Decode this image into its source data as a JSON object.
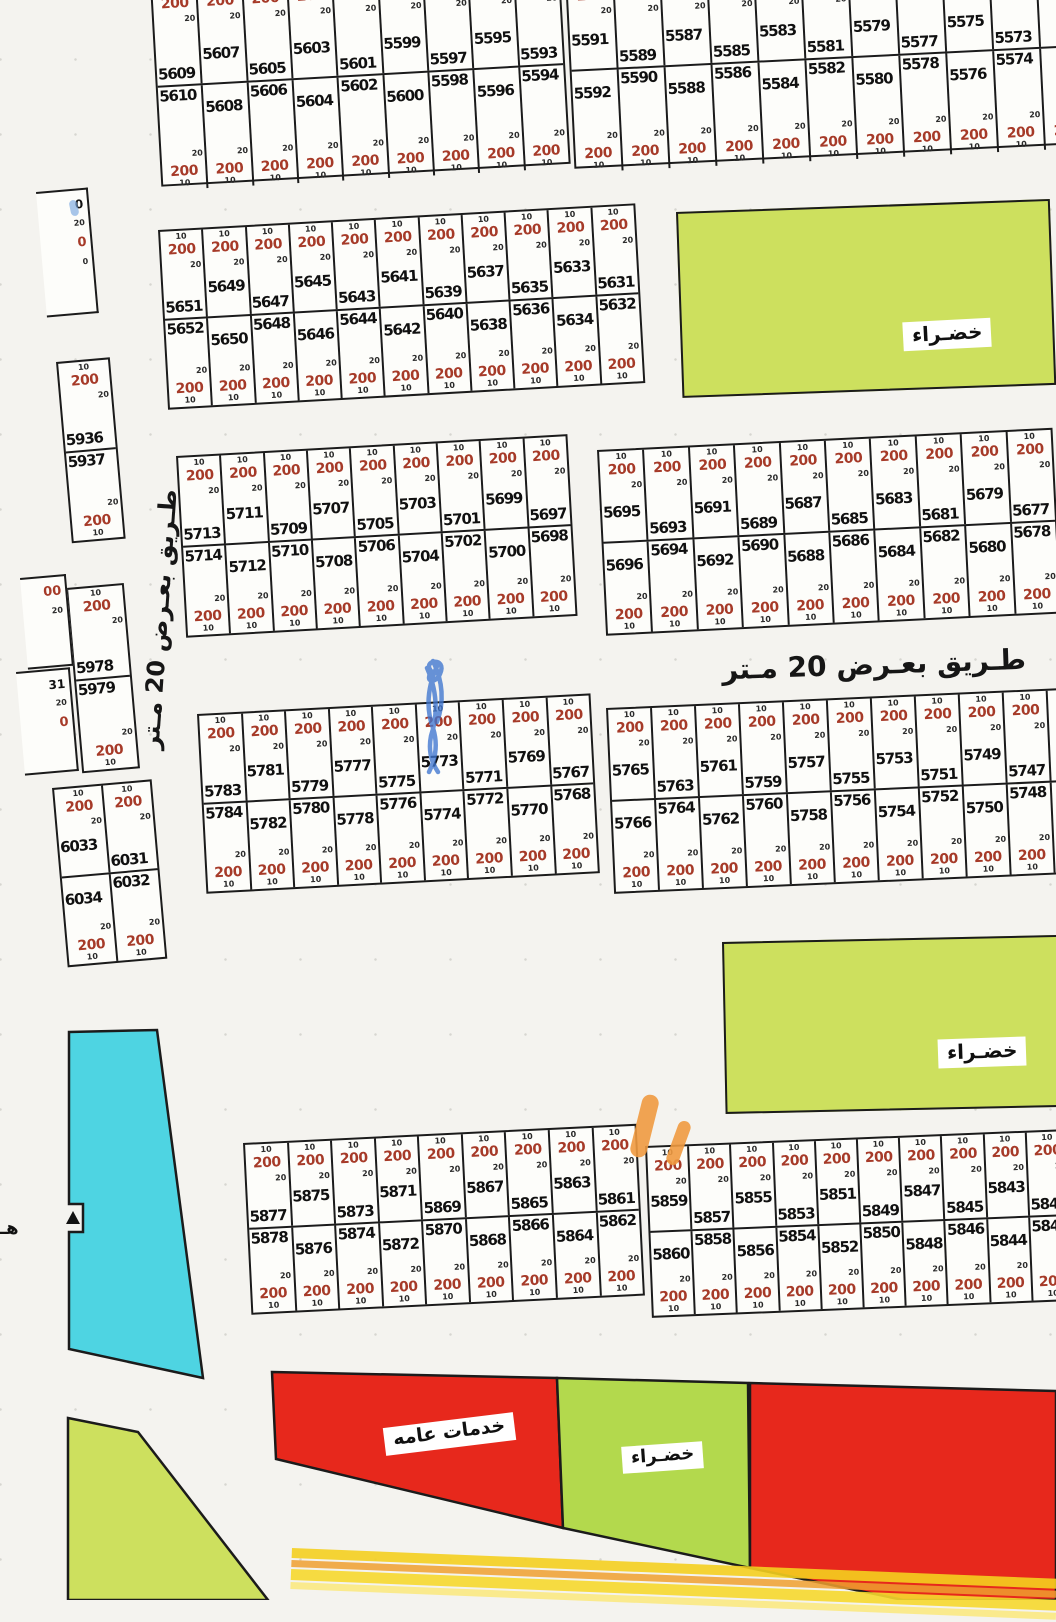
{
  "road": {
    "horizontal": "طـريق بعـرض 20 مـتر",
    "vertical": "طـريق بعـرض 20 مـتر"
  },
  "zones": {
    "green_top": {
      "label": "خضـراء"
    },
    "green_mid": {
      "label": "خضـراء"
    },
    "green_bottom": {
      "label": "خضـراء"
    },
    "services": {
      "label": "خدمات عامه"
    }
  },
  "plot_cell": {
    "top_dim": "10",
    "area_value": "200",
    "side_dim": "20",
    "bottom_dim": "10"
  },
  "colors": {
    "plot_value_red": "#a63a28",
    "zone_green": "#cde05e",
    "zone_green_bottom": "#b3d94d",
    "zone_red": "#e7281c",
    "zone_cyan": "#4ed4e2",
    "highlight_orange": "#f09a40",
    "highlight_yellow": "#f4cf1f",
    "pen_blue": "#3f76d0"
  },
  "misc": {
    "edge_letter": "هـ"
  },
  "blocks": [
    {
      "id": "A",
      "x": 150,
      "y": -16,
      "w": 410,
      "h": 203,
      "rot": -3.2,
      "zz": 0,
      "rh": [
        100,
        103
      ],
      "top_row": [
        "5609",
        "5607",
        "5605",
        "5603",
        "5601",
        "5599",
        "5597",
        "5595",
        "5593"
      ],
      "bottom_row": [
        "5610",
        "5608",
        "5606",
        "5604",
        "5602",
        "5600",
        "5598",
        "5596",
        "5594"
      ]
    },
    {
      "id": "B",
      "x": 565,
      "y": -24,
      "w": 519,
      "h": 193,
      "rot": -2.8,
      "zz": 1,
      "rh": [
        92,
        101
      ],
      "top_row": [
        "5591",
        "5589",
        "5587",
        "5585",
        "5583",
        "5581",
        "5579",
        "5577",
        "5575",
        "5573",
        ""
      ],
      "bottom_row": [
        "5592",
        "5590",
        "5588",
        "5586",
        "5584",
        "5582",
        "5580",
        "5578",
        "5576",
        "5574",
        ""
      ]
    },
    {
      "id": "C",
      "x": 158,
      "y": 230,
      "w": 478,
      "h": 180,
      "rot": -3.2,
      "zz": 0,
      "top_row": [
        "5651",
        "5649",
        "5647",
        "5645",
        "5643",
        "5641",
        "5639",
        "5637",
        "5635",
        "5633",
        "5631"
      ],
      "bottom_row": [
        "5652",
        "5650",
        "5648",
        "5646",
        "5644",
        "5642",
        "5640",
        "5638",
        "5636",
        "5634",
        "5632"
      ]
    },
    {
      "id": "D",
      "x": 176,
      "y": 456,
      "w": 392,
      "h": 182,
      "rot": -3.2,
      "zz": 0,
      "top_row": [
        "5713",
        "5711",
        "5709",
        "5707",
        "5705",
        "5703",
        "5701",
        "5699",
        "5697"
      ],
      "bottom_row": [
        "5714",
        "5712",
        "5710",
        "5708",
        "5706",
        "5704",
        "5702",
        "5700",
        "5698"
      ]
    },
    {
      "id": "E",
      "x": 597,
      "y": 450,
      "w": 456,
      "h": 186,
      "rot": -2.8,
      "zz": 1,
      "top_row": [
        "5695",
        "5693",
        "5691",
        "5689",
        "5687",
        "5685",
        "5683",
        "5681",
        "5679",
        "5677"
      ],
      "bottom_row": [
        "5696",
        "5694",
        "5692",
        "5690",
        "5688",
        "5686",
        "5684",
        "5682",
        "5680",
        "5678"
      ]
    },
    {
      "id": "F",
      "x": 197,
      "y": 714,
      "w": 394,
      "h": 180,
      "rot": -3,
      "zz": 0,
      "top_row": [
        "5783",
        "5781",
        "5779",
        "5777",
        "5775",
        "5773",
        "5771",
        "5769",
        "5767"
      ],
      "bottom_row": [
        "5784",
        "5782",
        "5780",
        "5778",
        "5776",
        "5774",
        "5772",
        "5770",
        "5768"
      ]
    },
    {
      "id": "G",
      "x": 606,
      "y": 708,
      "w": 486,
      "h": 186,
      "rot": -2.5,
      "zz": 1,
      "top_row": [
        "5765",
        "5763",
        "5761",
        "5759",
        "5757",
        "5755",
        "5753",
        "5751",
        "5749",
        "5747",
        ""
      ],
      "bottom_row": [
        "5766",
        "5764",
        "5762",
        "5760",
        "5758",
        "5756",
        "5754",
        "5752",
        "5750",
        "5748",
        ""
      ]
    },
    {
      "id": "H",
      "x": 243,
      "y": 1143,
      "w": 394,
      "h": 172,
      "rot": -2.8,
      "zz": 0,
      "top_row": [
        "5877",
        "5875",
        "5873",
        "5871",
        "5869",
        "5867",
        "5865",
        "5863",
        "5861"
      ],
      "bottom_row": [
        "5878",
        "5876",
        "5874",
        "5872",
        "5870",
        "5868",
        "5866",
        "5864",
        "5862"
      ]
    },
    {
      "id": "I",
      "x": 645,
      "y": 1146,
      "w": 424,
      "h": 172,
      "rot": -2.3,
      "zz": 1,
      "top_row": [
        "5859",
        "5857",
        "5855",
        "5853",
        "5851",
        "5849",
        "5847",
        "5845",
        "5843",
        "584"
      ],
      "bottom_row": [
        "5860",
        "5858",
        "5856",
        "5854",
        "5852",
        "5850",
        "5848",
        "5846",
        "5844",
        "584"
      ]
    },
    {
      "id": "L1",
      "x": 56,
      "y": 362,
      "w": 54,
      "h": 182,
      "rot": -5,
      "zz": 0,
      "top_row": [
        "5936"
      ],
      "bottom_row": [
        "5937"
      ]
    },
    {
      "id": "L2",
      "x": 66,
      "y": 588,
      "w": 58,
      "h": 186,
      "rot": -5,
      "zz": 0,
      "top_row": [
        "5978"
      ],
      "bottom_row": [
        "5979"
      ]
    },
    {
      "id": "L3",
      "x": 52,
      "y": 788,
      "w": 100,
      "h": 180,
      "rot": -5,
      "zz": 1,
      "top_row": [
        "6033",
        "6031"
      ],
      "bottom_row": [
        "6034",
        "6032"
      ]
    }
  ],
  "fragments": [
    {
      "x": 36,
      "y": 192,
      "w": 52,
      "h": 126,
      "rot": -5,
      "lines": [
        [
          "0",
          "k"
        ],
        [
          "20",
          "s"
        ],
        [
          "0",
          "r"
        ],
        [
          "0",
          "s"
        ]
      ]
    },
    {
      "x": 20,
      "y": 578,
      "w": 46,
      "h": 92,
      "rot": -5,
      "lines": [
        [
          "00",
          "r"
        ],
        [
          "20",
          "s"
        ]
      ]
    },
    {
      "x": 16,
      "y": 672,
      "w": 54,
      "h": 104,
      "rot": -5,
      "lines": [
        [
          "31",
          "k"
        ],
        [
          "20",
          "s"
        ],
        [
          "0",
          "r"
        ]
      ]
    }
  ]
}
